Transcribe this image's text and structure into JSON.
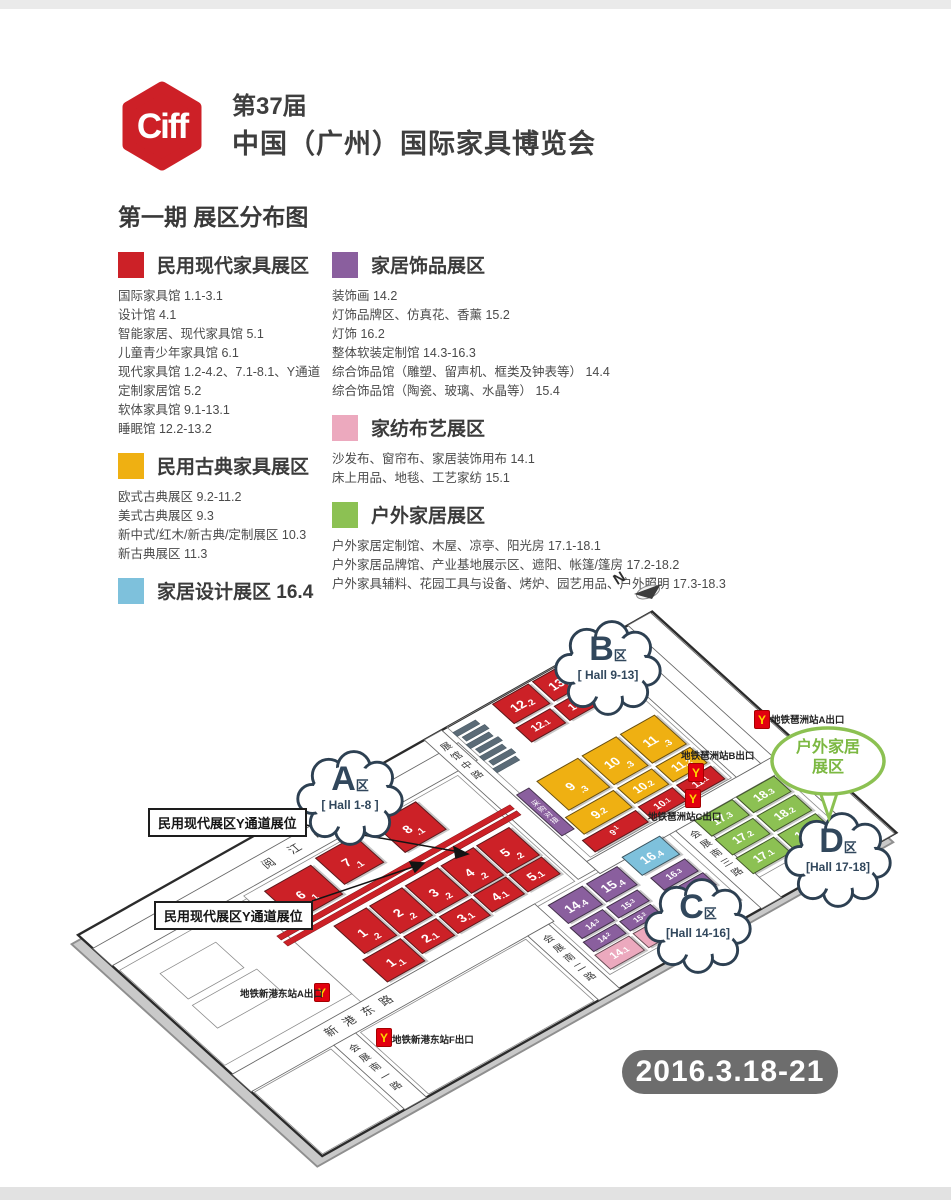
{
  "palette": {
    "red": "#cc2127",
    "yellow": "#efb012",
    "blue": "#7ec1dc",
    "purple": "#8a5f9e",
    "pink": "#eca9be",
    "green": "#8cc153",
    "cloud_outline": "#2d4052",
    "cloud_text": "#31475c",
    "bubble_green": "#8cc152",
    "badge_gray": "#6d6d6d",
    "logo_red": "#cd2027",
    "metro_red": "#e2000f",
    "metro_yellow": "#ffd800"
  },
  "header": {
    "logo_text": "Ciff",
    "edition": "第37届",
    "title": "中国（广州）国际家具博览会",
    "subtitle": "第一期 展区分布图"
  },
  "legend": {
    "sections": [
      {
        "key": "red",
        "title": "民用现代家具展区",
        "items": [
          "国际家具馆 1.1-3.1",
          "设计馆 4.1",
          "智能家居、现代家具馆 5.1",
          "儿童青少年家具馆 6.1",
          "现代家具馆 1.2-4.2、7.1-8.1、Y通道",
          "定制家居馆 5.2",
          "软体家具馆 9.1-13.1",
          "睡眠馆 12.2-13.2"
        ]
      },
      {
        "key": "yellow",
        "title": "民用古典家具展区",
        "items": [
          "欧式古典展区 9.2-11.2",
          "美式古典展区 9.3",
          "新中式/红木/新古典/定制展区 10.3",
          "新古典展区 11.3"
        ]
      },
      {
        "key": "blue",
        "title": "家居设计展区 16.4",
        "items": []
      },
      {
        "key": "purple",
        "title": "家居饰品展区",
        "items": [
          "装饰画 14.2",
          "灯饰品牌区、仿真花、香薰 15.2",
          "灯饰 16.2",
          "整体软装定制馆 14.3-16.3",
          "综合饰品馆（雕塑、留声机、框类及钟表等） 14.4",
          "综合饰品馆（陶瓷、玻璃、水晶等） 15.4"
        ]
      },
      {
        "key": "pink",
        "title": "家纺布艺展区",
        "items": [
          "沙发布、窗帘布、家居装饰用布 14.1",
          "床上用品、地毯、工艺家纺 15.1"
        ]
      },
      {
        "key": "green",
        "title": "户外家居展区",
        "items": [
          "户外家居定制馆、木屋、凉亭、阳光房 17.1-18.1",
          "户外家居品牌馆、产业基地展示区、遮阳、帐篷/篷房 17.2-18.2",
          "户外家具辅料、花园工具与设备、烤炉、园艺用品、户外照明 17.3-18.3"
        ]
      }
    ]
  },
  "map": {
    "north_label": "N",
    "date_label": "2016.3.18-21",
    "callout_label": "民用现代展区Y通道展位",
    "strip_label": "采购对接",
    "metro_icon": "Y",
    "roads": {
      "yuejiang": "阅江中路",
      "zhanguan": "展馆中路",
      "xingang": "新港东路",
      "nan1": "会展南一路",
      "nan2": "会展南二路",
      "nan3": "会展南三路"
    },
    "zones": [
      {
        "letter": "A",
        "suffix": "区",
        "hall": "[ Hall 1-8 ]"
      },
      {
        "letter": "B",
        "suffix": "区",
        "hall": "[ Hall 9-13]"
      },
      {
        "letter": "C",
        "suffix": "区",
        "hall": "[Hall 14-16]"
      },
      {
        "letter": "D",
        "suffix": "区",
        "hall": "[Hall 17-18]"
      }
    ],
    "bubble": {
      "line1": "户外家居",
      "line2": "展区"
    },
    "metro": [
      "地铁琶洲站A出口",
      "地铁琶洲站B出口",
      "地铁琶洲站C出口",
      "地铁新港东站A出口",
      "地铁新港东站F出口"
    ],
    "halls": [
      {
        "label": "1.1",
        "cat": "red"
      },
      {
        "label": "1.2",
        "cat": "red"
      },
      {
        "label": "2.1",
        "cat": "red"
      },
      {
        "label": "2.2",
        "cat": "red"
      },
      {
        "label": "3.1",
        "cat": "red"
      },
      {
        "label": "3.2",
        "cat": "red"
      },
      {
        "label": "4.1",
        "cat": "red"
      },
      {
        "label": "4.2",
        "cat": "red"
      },
      {
        "label": "5.1",
        "cat": "red"
      },
      {
        "label": "5.2",
        "cat": "red"
      },
      {
        "label": "6.1",
        "cat": "red"
      },
      {
        "label": "7.1",
        "cat": "red"
      },
      {
        "label": "8.1",
        "cat": "red"
      },
      {
        "label": "9.1",
        "cat": "red"
      },
      {
        "label": "10.1",
        "cat": "red"
      },
      {
        "label": "11.1",
        "cat": "red"
      },
      {
        "label": "12.1",
        "cat": "red"
      },
      {
        "label": "12.2",
        "cat": "red"
      },
      {
        "label": "13.1",
        "cat": "red"
      },
      {
        "label": "13.2",
        "cat": "red"
      },
      {
        "label": "9.2",
        "cat": "yellow"
      },
      {
        "label": "9.3",
        "cat": "yellow"
      },
      {
        "label": "10.2",
        "cat": "yellow"
      },
      {
        "label": "10.3",
        "cat": "yellow"
      },
      {
        "label": "11.2",
        "cat": "yellow"
      },
      {
        "label": "11.3",
        "cat": "yellow"
      },
      {
        "label": "14.2",
        "cat": "purple"
      },
      {
        "label": "14.3",
        "cat": "purple"
      },
      {
        "label": "14.4",
        "cat": "purple"
      },
      {
        "label": "15.2",
        "cat": "purple"
      },
      {
        "label": "15.3",
        "cat": "purple"
      },
      {
        "label": "15.4",
        "cat": "purple"
      },
      {
        "label": "16.1",
        "cat": "purple"
      },
      {
        "label": "16.3",
        "cat": "purple"
      },
      {
        "label": "14.1",
        "cat": "pink"
      },
      {
        "label": "15.1",
        "cat": "pink"
      },
      {
        "label": "16.4",
        "cat": "blue"
      },
      {
        "label": "17.1",
        "cat": "green"
      },
      {
        "label": "17.2",
        "cat": "green"
      },
      {
        "label": "17.3",
        "cat": "green"
      },
      {
        "label": "18.1",
        "cat": "green"
      },
      {
        "label": "18.2",
        "cat": "green"
      },
      {
        "label": "18.3",
        "cat": "green"
      }
    ]
  }
}
